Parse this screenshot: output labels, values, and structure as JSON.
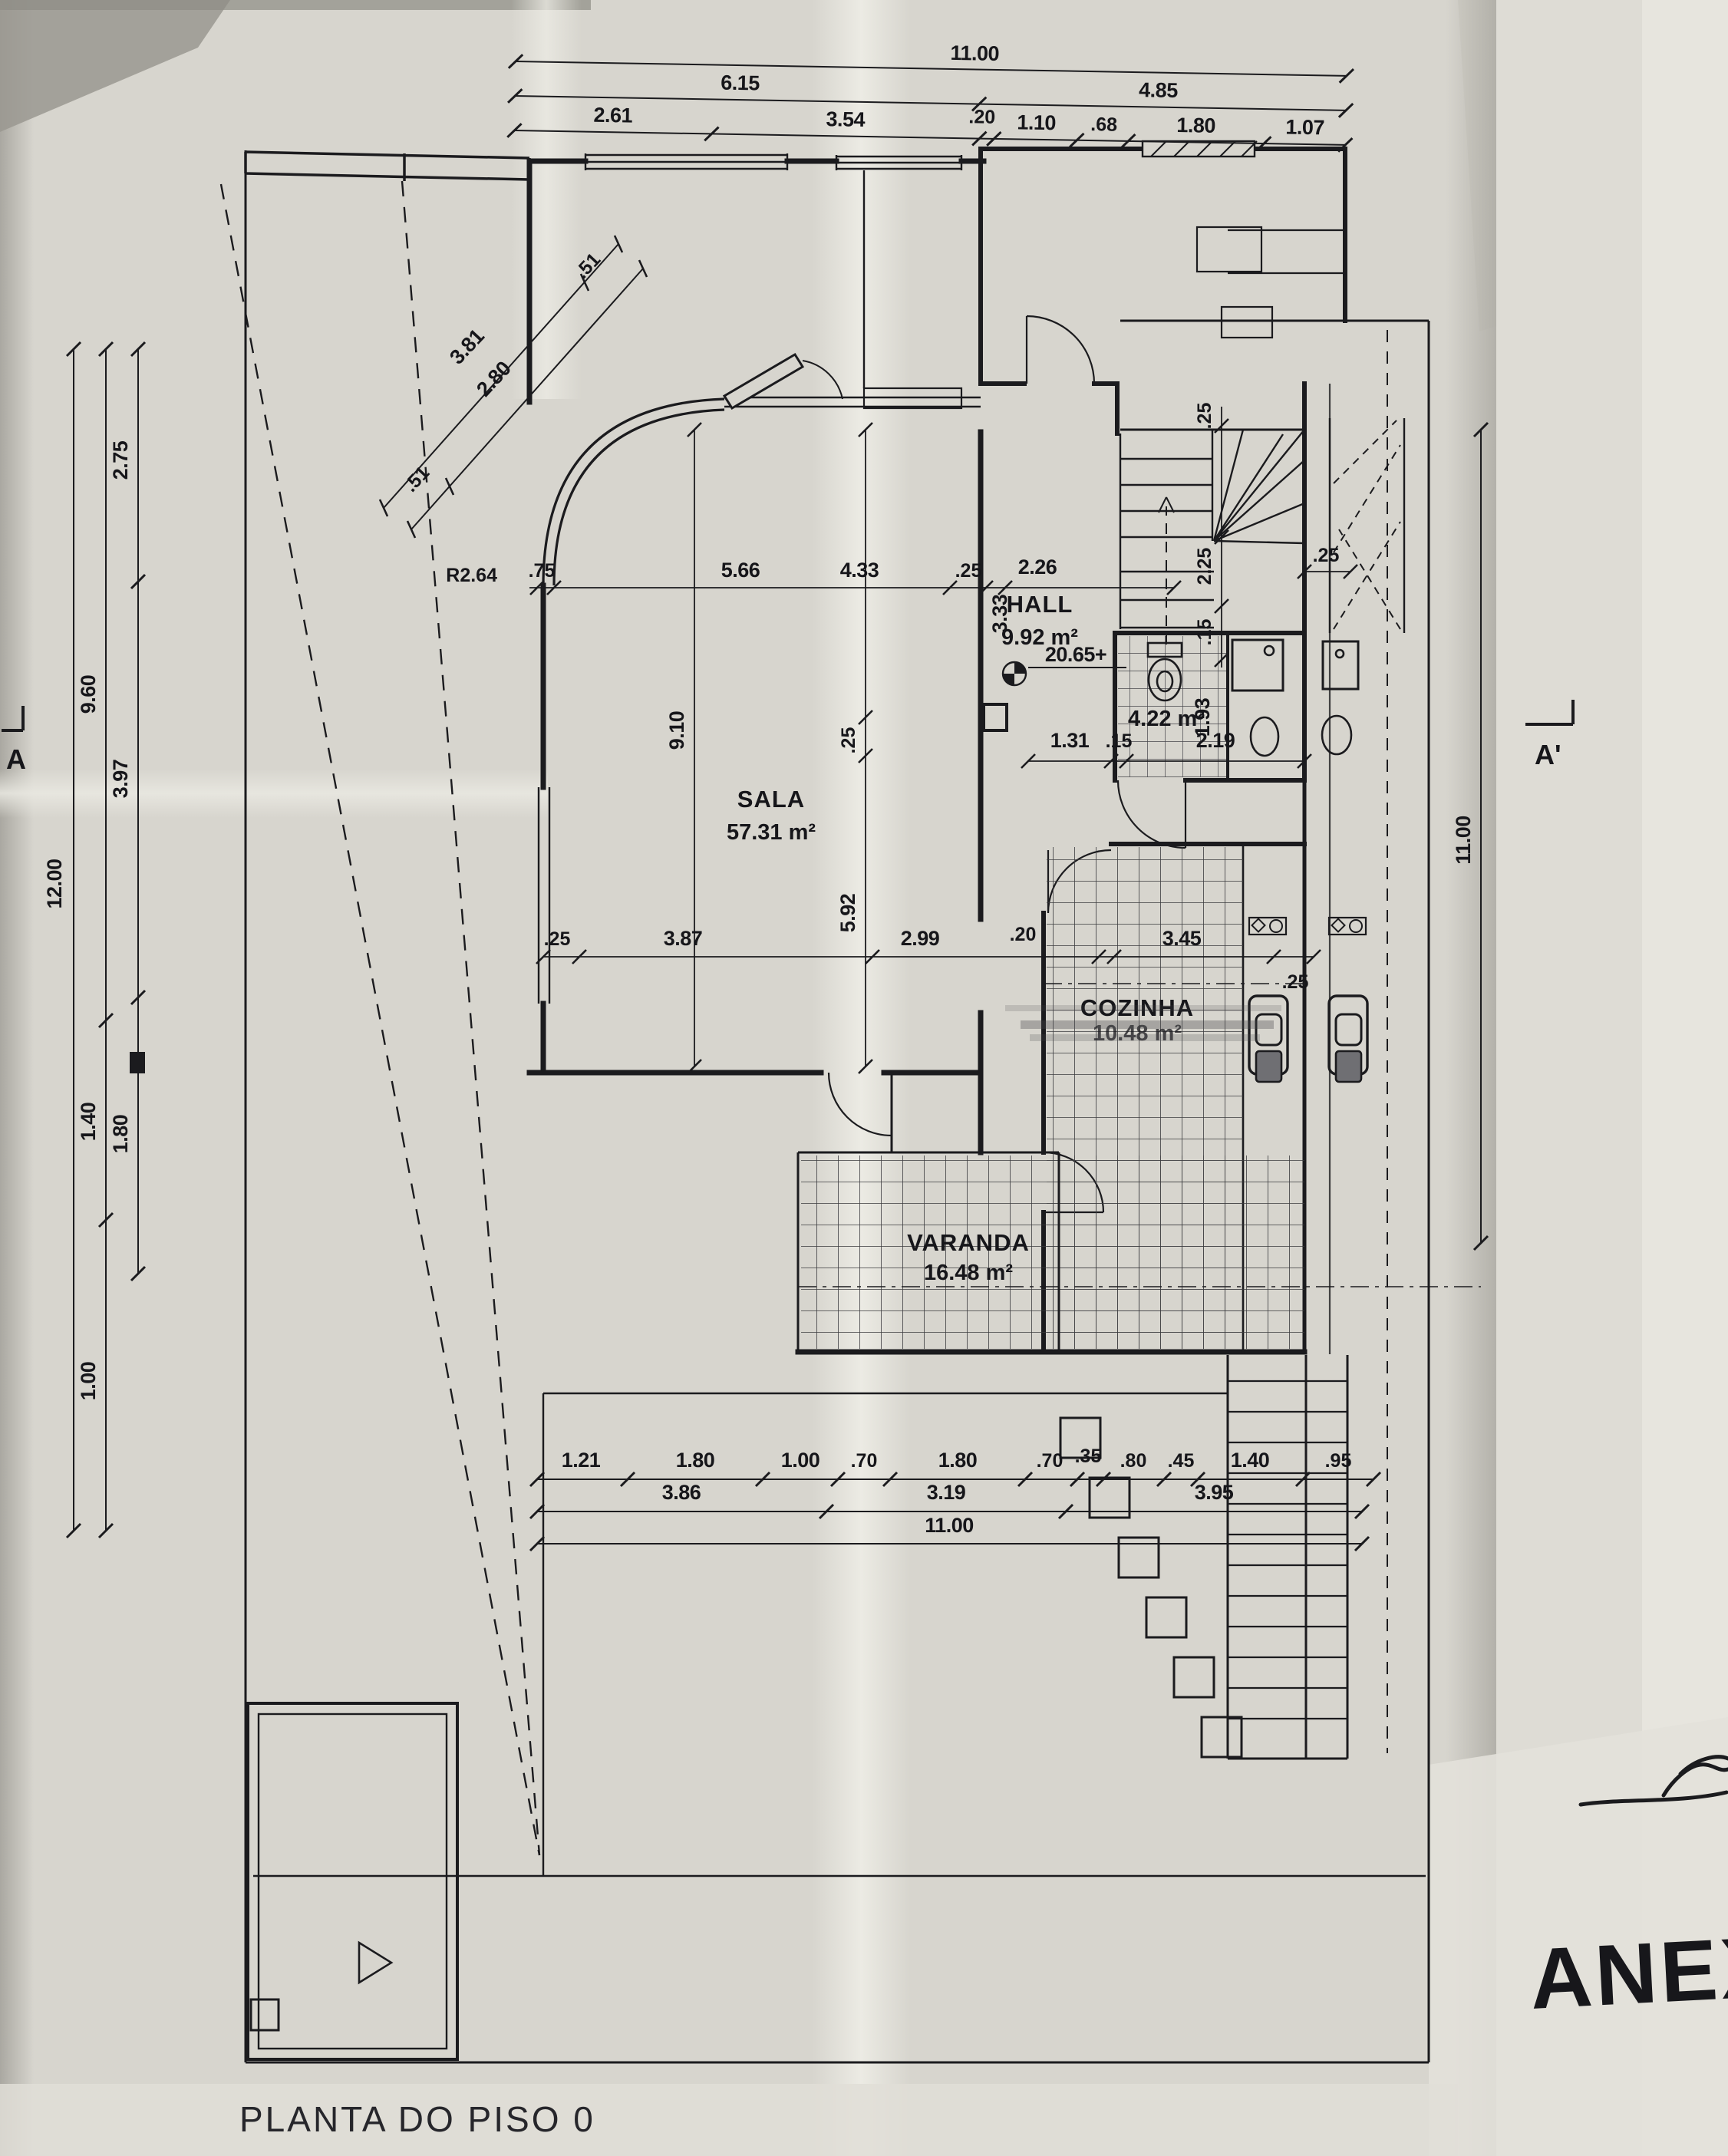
{
  "title_block": {
    "title": "PLANTA DO PISO 0",
    "annex_note": "ANEXO"
  },
  "rooms": {
    "sala": {
      "name": "SALA",
      "area": "57.31 m²"
    },
    "hall": {
      "name": "HALL",
      "area": "9.92 m²"
    },
    "bath": {
      "area": "4.22 m²"
    },
    "kitchen": {
      "name": "COZINHA",
      "area": "10.48 m²"
    },
    "varanda": {
      "name": "VARANDA",
      "area": "16.48 m²"
    }
  },
  "marks": {
    "level": "20.65+",
    "radius": "R2.64",
    "section_left": "A",
    "section_right": "A'"
  },
  "dims": {
    "top_total": "11.00",
    "top_mid": [
      "6.15",
      "4.85"
    ],
    "top_detail": [
      "2.61",
      "3.54",
      ".20",
      "1.10",
      ".68",
      "1.80",
      "1.07"
    ],
    "left_total": "12.00",
    "left_mid": [
      "9.60",
      "1.40",
      "1.00"
    ],
    "left_inner": [
      "2.75",
      "3.97",
      "1.80"
    ],
    "right_total": "11.00",
    "bottom_detail": [
      "1.21",
      "1.80",
      "1.00",
      ".70",
      "1.80",
      ".70",
      ".35",
      ".80",
      ".45",
      "1.40",
      ".95"
    ],
    "bottom_mid": [
      "3.86",
      "3.19",
      "3.95"
    ],
    "bottom_total": "11.00",
    "diag": [
      "3.81",
      "2.80",
      ".51",
      ".51"
    ],
    "upper_chain": [
      ".75",
      "5.66",
      "4.33",
      ".25",
      "2.26"
    ],
    "hall_side": "3.33",
    "sala_col": [
      ".25",
      "5.92"
    ],
    "sala_height": "9.10",
    "mid_chain": [
      ".25",
      "3.87",
      "2.99",
      ".20",
      "3.45",
      ".25"
    ],
    "bath_row": [
      "1.31",
      ".15",
      "2.19"
    ],
    "bath_col": "1.93",
    "stair_col": [
      ".25",
      "2.25",
      ".15"
    ],
    "stair_side": ".25"
  }
}
